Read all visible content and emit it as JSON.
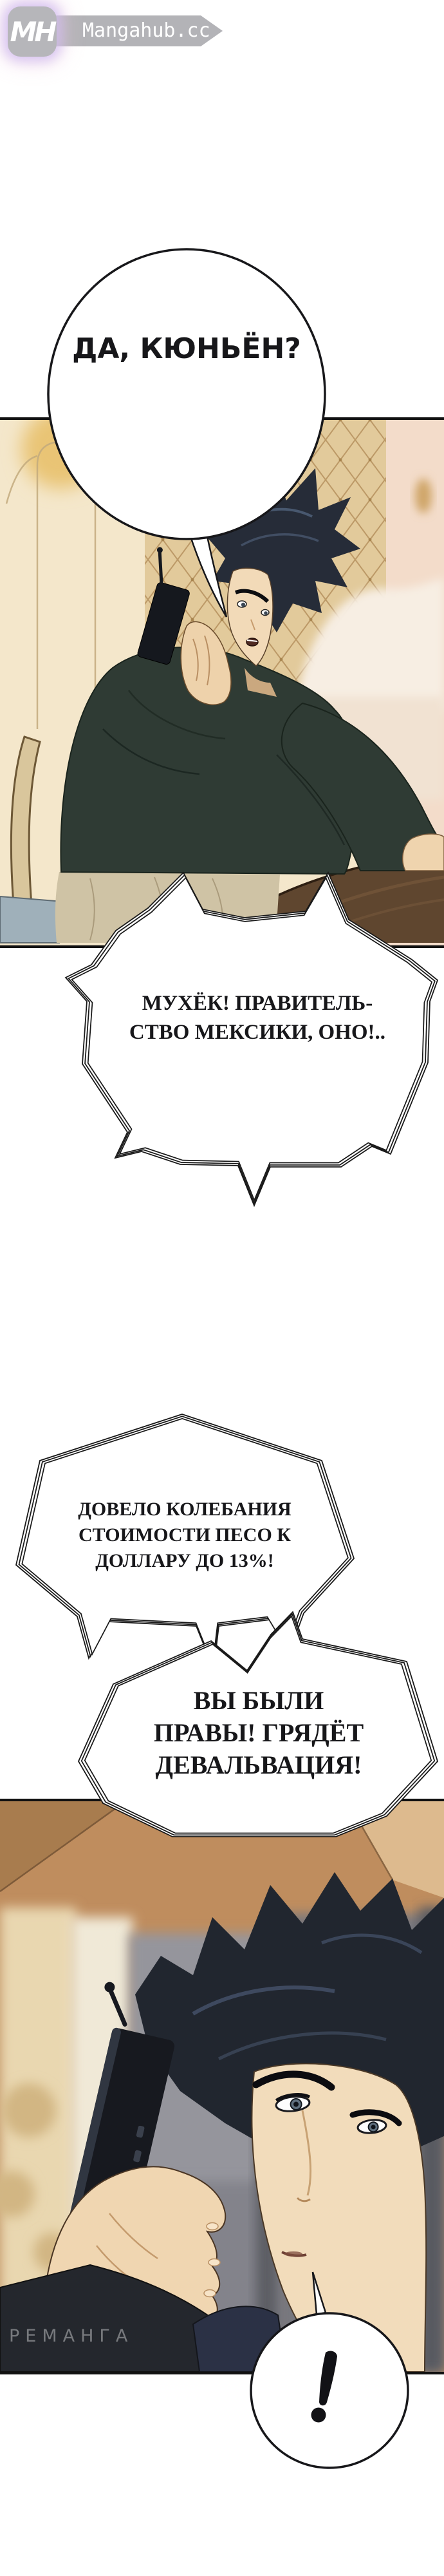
{
  "site_badge": {
    "monogram": "MH",
    "site_name": "Mangahub.cc"
  },
  "speech_bubbles": {
    "bubble_1": {
      "text": "ДА, КЮНЬЁН?"
    },
    "bubble_2": {
      "lines": [
        "МУХЁК! ПРАВИТЕЛЬ-",
        "СТВО МЕКСИКИ, ОНО!.."
      ]
    },
    "bubble_3": {
      "lines": [
        "ДОВЕЛО КОЛЕБАНИЯ",
        "СТОИМОСТИ ПЕСО К",
        "ДОЛЛАРУ ДО 13%!"
      ]
    },
    "bubble_4": {
      "lines": [
        "ВЫ БЫЛИ",
        "ПРАВЫ! ГРЯДЁТ",
        "ДЕВАЛЬВАЦИЯ!"
      ]
    },
    "bubble_5": {
      "text": "!"
    }
  },
  "watermark": {
    "text": "РЕМАНГА"
  },
  "colors": {
    "page_background": "#ffffff",
    "logo_gray": "#b4b4b8",
    "logo_glow_pink": "#f3cfe0",
    "logo_glow_purple": "#cfc0f0",
    "bubble_outline": "#1a1a1a",
    "panel1_wall_cream": "#f4e7cb",
    "headboard_tan": "#ead3a3",
    "sweater_green": "#2f3b34",
    "table_brown": "#5f462f",
    "panel2_ceiling_brown": "#bf8d5e",
    "hair_dark": "#21262f",
    "skin_tone": "#f2dcbb"
  }
}
